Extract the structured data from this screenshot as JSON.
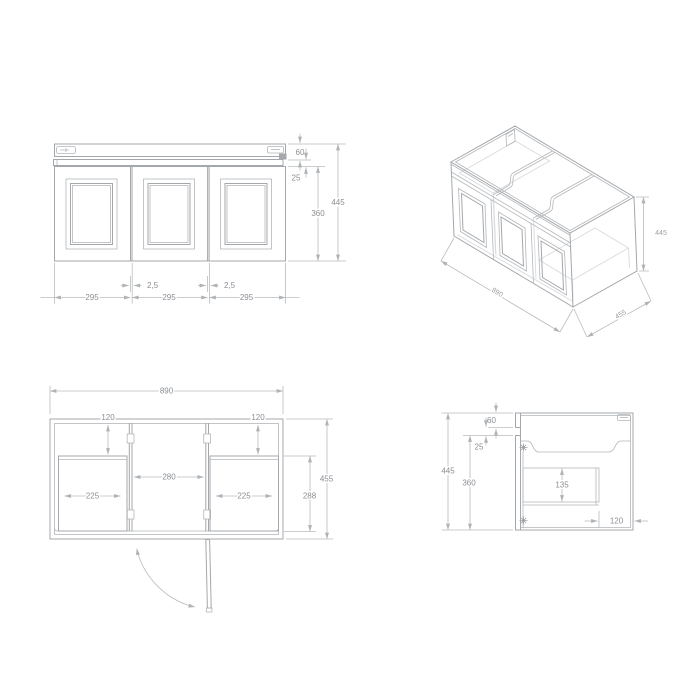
{
  "colors": {
    "background": "#ffffff",
    "line": "#a4a7ab",
    "light_line": "#d8dadc",
    "dimension_line": "#b9bcbf",
    "dimension_text": "#8b8e93"
  },
  "front_view": {
    "counter_height": "60",
    "gap_height": "25",
    "door_height": "360",
    "total_height": "445",
    "door_gap_left": "2,5",
    "door_gap_right": "2,5",
    "door_width_1": "295",
    "door_width_2": "295",
    "door_width_3": "295"
  },
  "iso_view": {
    "width": "890",
    "depth": "455",
    "height": "445"
  },
  "plan_view": {
    "width": "890",
    "offset_left": "120",
    "offset_right": "120",
    "opening_center": "280",
    "opening_left": "225",
    "opening_right": "225",
    "depth": "455",
    "inner_depth": "288"
  },
  "side_view": {
    "counter_height": "60",
    "gap_height": "25",
    "total_height": "445",
    "door_height": "360",
    "shelf_depth": "135",
    "back_offset": "120"
  }
}
